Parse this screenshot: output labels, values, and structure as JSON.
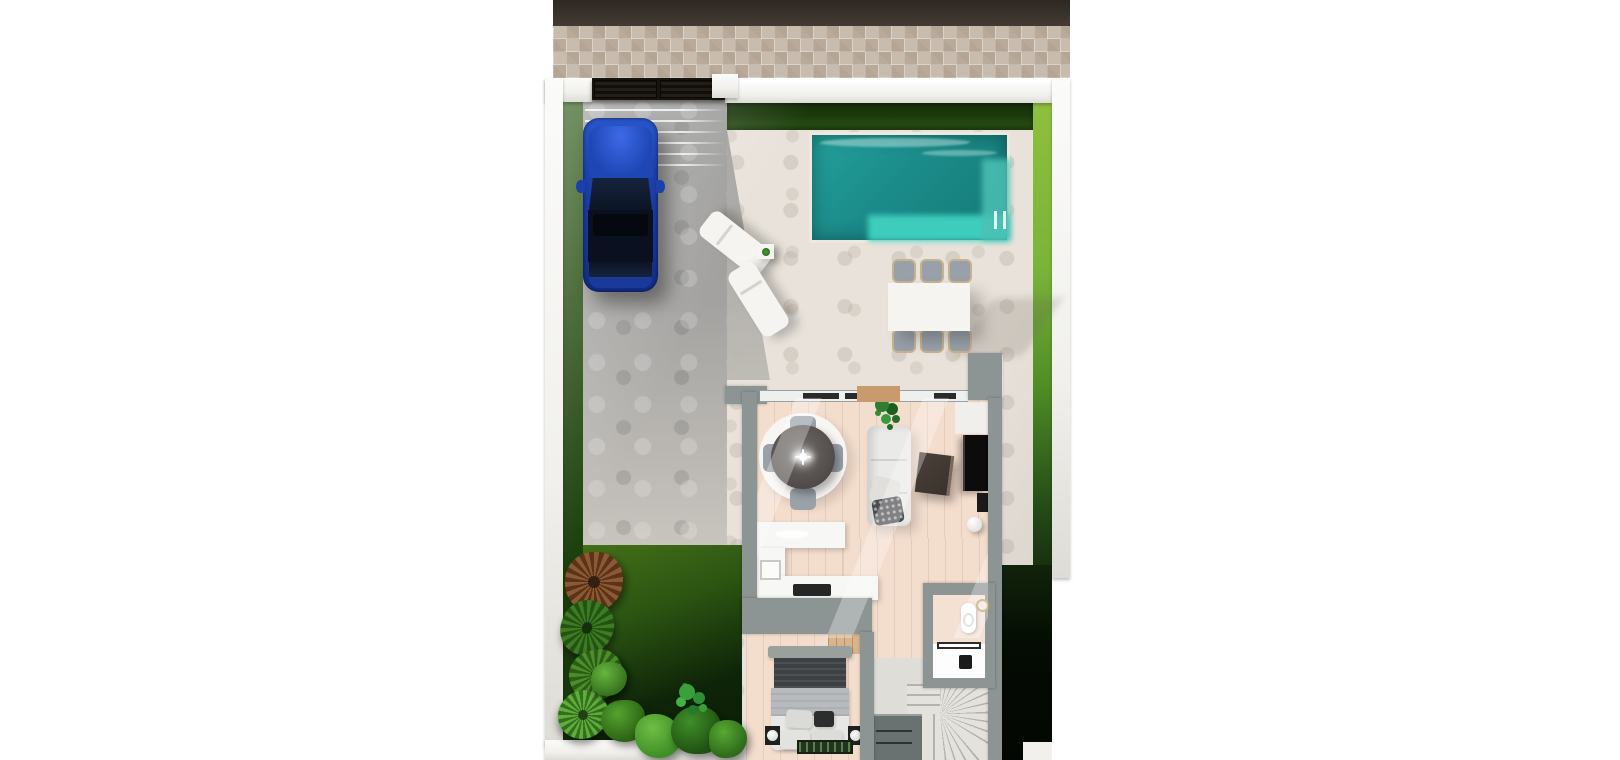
{
  "scene": {
    "title": "Top-down 3D architectural render — ground floor of a villa plot",
    "type": "3d-floorplan-render",
    "areas": [
      "street road",
      "tiled sidewalk",
      "entrance gate with white pillars",
      "paved driveway with blue car",
      "rectangular swimming pool with shallow ledge and ladder",
      "sun terrace with two white loungers and side table with plant",
      "outdoor dining table with six chairs",
      "lawn garden with tropical plants",
      "living room with round dining table, four chairs, round rug, sofa, coffee table and TV wall",
      "kitchen with L-shaped counter, sink and cooktop",
      "bedroom with double bed, nightstands, lamps and closet",
      "bathroom with toilet, round mirror, shower and black tap",
      "winder staircase with storage cabinet",
      "dark neighbouring plot corner"
    ],
    "counts": {
      "cars": 1,
      "loungers": 2,
      "outdoor_dining_chairs": 6,
      "indoor_table_chairs": 4,
      "beds": 1
    },
    "palette": {
      "road": "#3a332c",
      "sidewalk": "#c8bcae",
      "wall": "#f1f0ec",
      "gate": "#17130f",
      "grassLeft": "#24490f",
      "grassRight": "#7ab438",
      "hedge": "#1d3b0e",
      "gardenTop": "#447019",
      "gardenDark": "#0e2408",
      "driveway": "#9b9b99",
      "patio": "#e8e2da",
      "poolDeep": "#1b8b89",
      "poolMid": "#23a09a",
      "poolShallow": "#3ecdbd",
      "carBody": "#1c40ab",
      "carGlass": "#0c1524",
      "carRoof": "#0a101f",
      "houseWall": "#8c9494",
      "floor": "#f3ddcd",
      "lintel": "#c89a6e",
      "tableRound": "#57524f",
      "rug": "#f8f6f3",
      "chairGray": "#98a0a9",
      "outdoorTable": "#f6f4f1",
      "loungerWhite": "#f5f4f0",
      "sofa": "#eaeae8",
      "throwDark": "#4a4b4d",
      "coffeeTable": "#3a322c",
      "tv": "#0c0c0c",
      "mediaWall": "#f0efeb",
      "counter": "#f7f7f5",
      "cooktop": "#262626",
      "bedFrame": "#9aa09c",
      "bedBlanket": "#3d4144",
      "bedDuvet": "#b8bbbd",
      "bedSheet": "#e7e8e5",
      "pillowDark": "#2c2d2d",
      "nightstand": "#1f2020",
      "closet": "#d9b58e",
      "bathFloor": "#f4e1d4",
      "shower": "#fdfdfd",
      "mirrorGold": "#c2a264",
      "fixtureBlack": "#1b1b1b",
      "stairTread": "#e4e2dd",
      "stairEdge": "#b5b3ad",
      "cabinet": "#6a7171"
    }
  }
}
